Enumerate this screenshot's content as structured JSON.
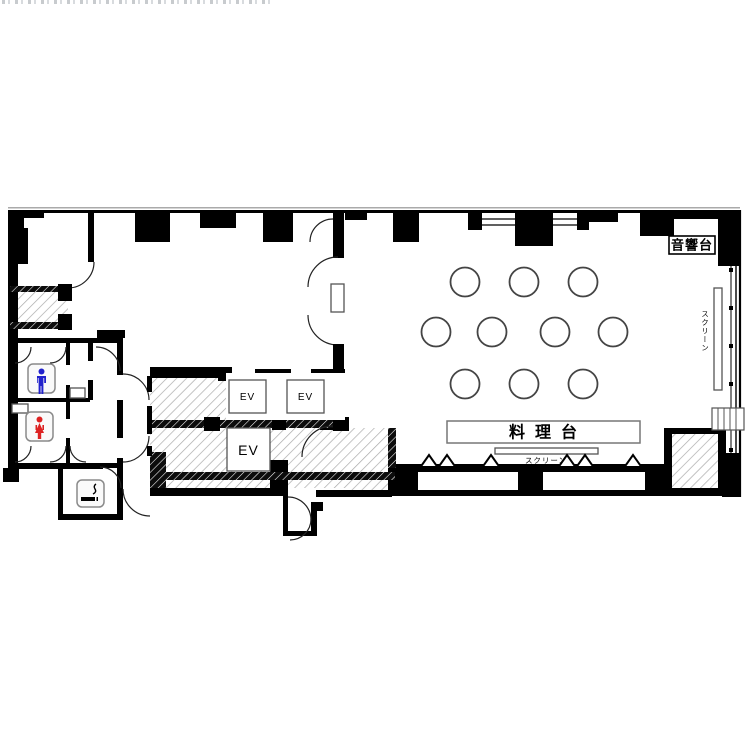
{
  "floor_plan": {
    "labels": {
      "ev": "EV",
      "audio_desk": "音響台",
      "cooking_counter": "料理台",
      "screen_side": "スクリーン",
      "screen_bottom": "スクリーン"
    },
    "elevators": {
      "count": 3,
      "label": "EV"
    },
    "rooms": {
      "male_restroom": {
        "icon": "male-figure",
        "icon_color": "#2222cc"
      },
      "female_restroom": {
        "icon": "female-figure",
        "icon_color": "#dd2222"
      },
      "smoking_room": {
        "icon": "cigarette",
        "icon_color": "#000000"
      }
    },
    "hall": {
      "round_tables_count": 10,
      "round_table_rows": [
        3,
        4,
        3
      ]
    },
    "colors": {
      "walls": "#000000",
      "hatch_line": "#aaaaaa",
      "background": "#ffffff"
    }
  }
}
